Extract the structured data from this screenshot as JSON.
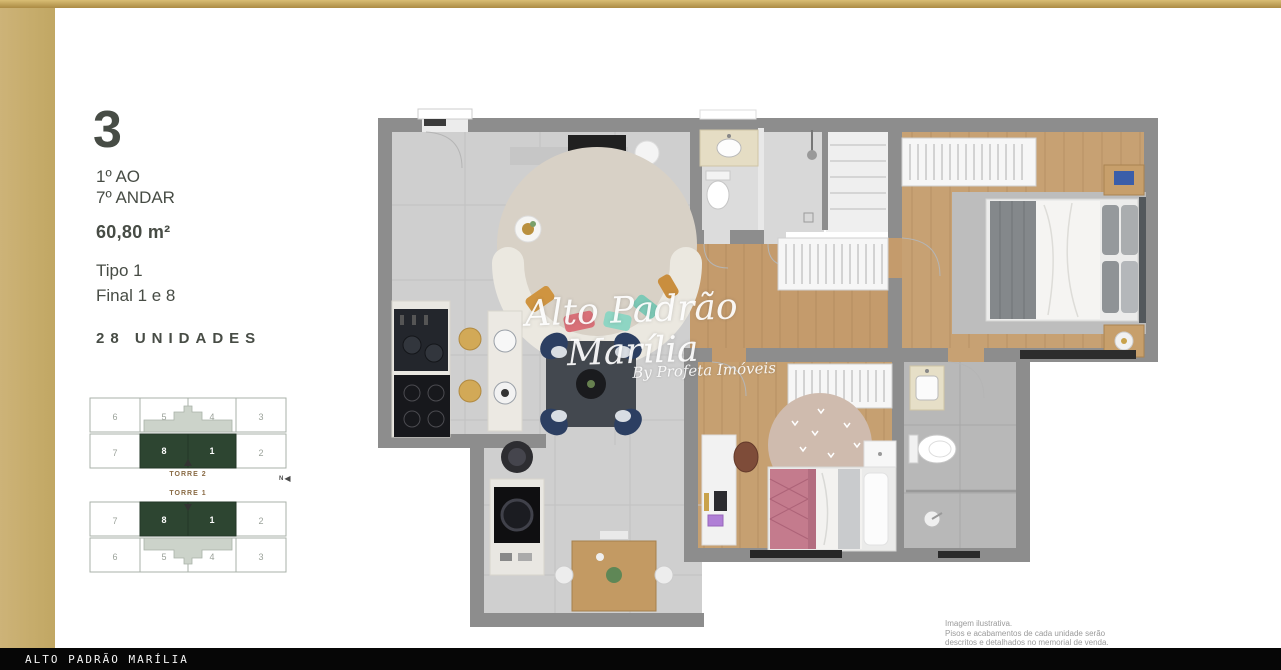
{
  "info_panel": {
    "plan_number": "3",
    "floor_range_line1": "1º AO",
    "floor_range_line2": "7º ANDAR",
    "area": "60,80 m²",
    "type_label": "Tipo 1",
    "finals_label": "Final 1 e 8",
    "units_label": "28 UNIDADES"
  },
  "towers": [
    {
      "name": "TORRE 2",
      "top_row": [
        "6",
        "5",
        "4",
        "3"
      ],
      "bottom_row": [
        "7",
        "8",
        "1",
        "2"
      ],
      "highlighted_units": [
        "8",
        "1"
      ]
    },
    {
      "name": "TORRE 1",
      "top_row": [
        "7",
        "8",
        "1",
        "2"
      ],
      "bottom_row": [
        "6",
        "5",
        "4",
        "3"
      ],
      "highlighted_units": [
        "8",
        "1"
      ]
    }
  ],
  "compass": {
    "label": "N"
  },
  "watermark": {
    "title": "Alto Padrão Marília",
    "subtitle": "By Profeta Imóveis"
  },
  "disclaimer": [
    "Imagem ilustrativa.",
    "Pisos e acabamentos de cada unidade serão",
    "descritos e detalhados no memorial de venda."
  ],
  "footer": {
    "brand": "ALTO PADRÃO MARÍLIA"
  },
  "colors": {
    "accent_gold": "#c7ab64",
    "highlight_green": "#2d4531",
    "wall_gray": "#8d8d8d",
    "wood_floor": "#c49b6c",
    "tile_floor": "#cfcfcf",
    "text_dark": "#474c45",
    "footer_bg": "#060606"
  }
}
